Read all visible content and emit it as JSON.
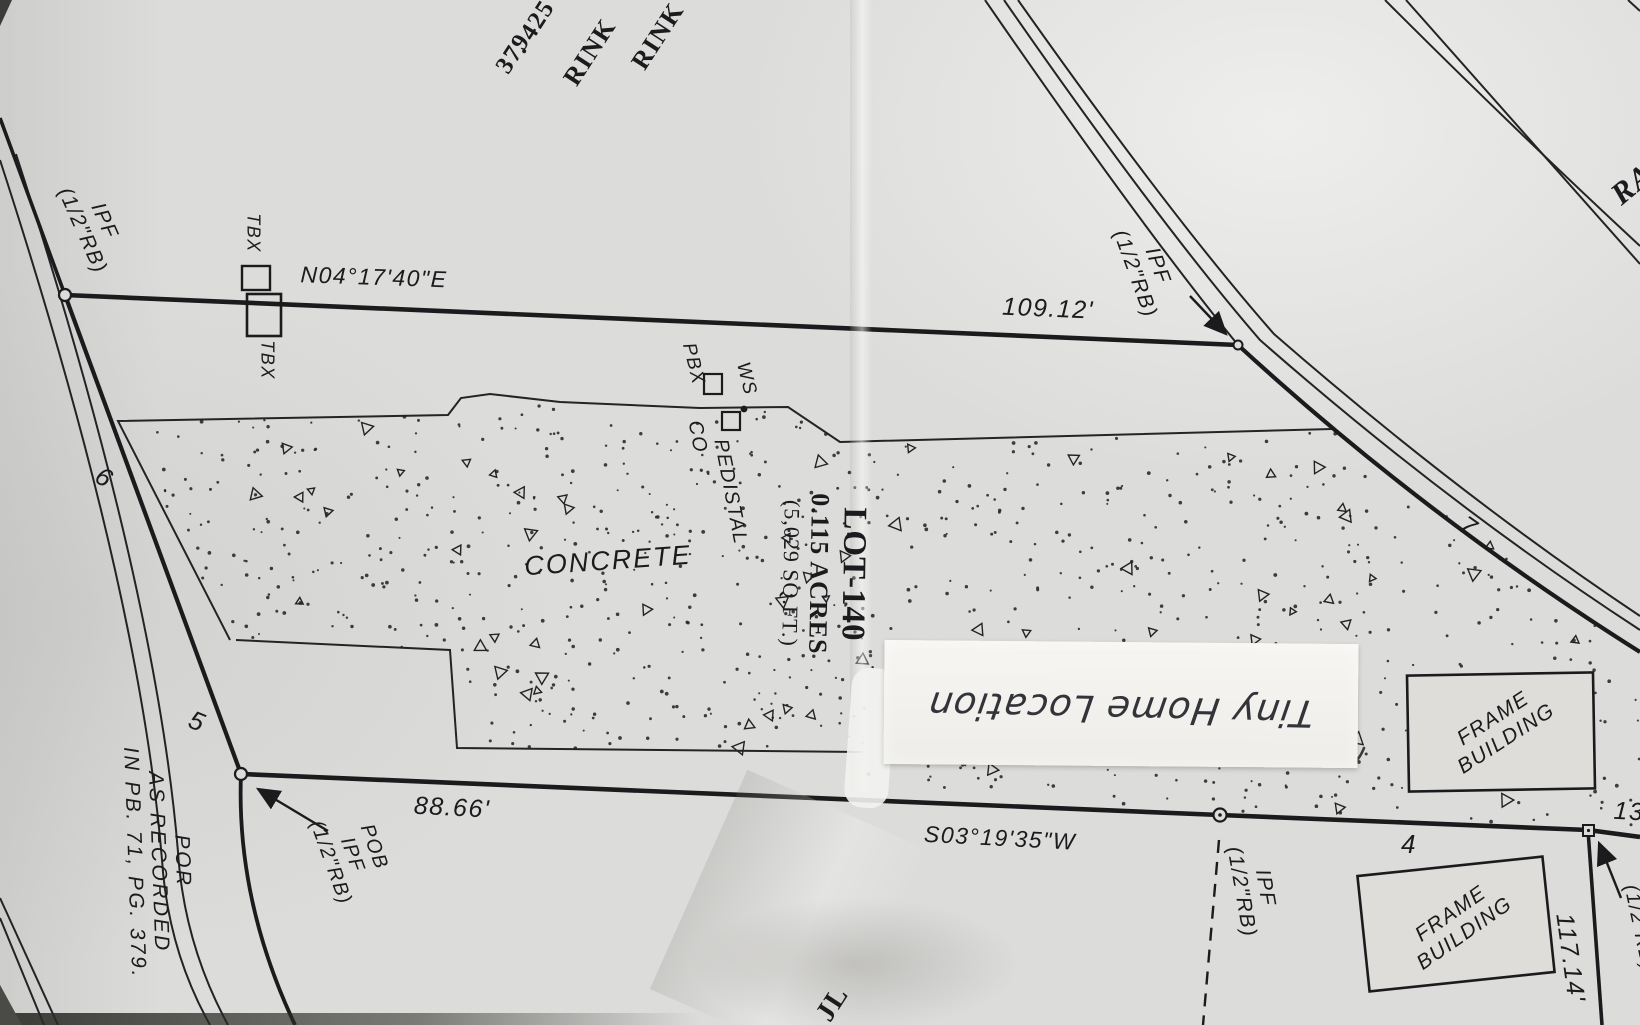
{
  "plat": {
    "corner_fragments": {
      "f1": "RINK",
      "f2": "RINK",
      "f3": ". 425",
      "f4": "379"
    },
    "bearings": {
      "top": "N04°17'40\"E",
      "bottom": "S03°19'35\"W"
    },
    "distances": {
      "top": "109.12'",
      "bottom": "88.66'",
      "right": "117.14'",
      "right_partial": "13"
    },
    "monuments": {
      "ipf_top_left": {
        "line1": "IPF",
        "line2": "(1/2\"RB)"
      },
      "ipf_top_right": {
        "line1": "IPF",
        "line2": "(1/2\"RB)"
      },
      "ipf_bottom": {
        "line1": "IPF",
        "line2": "(1/2\"RB)"
      },
      "ipf_bottom_right_partial": "(1/2\"RB)",
      "pob": {
        "line1": "POB",
        "line2": "IPF",
        "line3": "(1/2\"RB)"
      }
    },
    "labels": {
      "tbx_above": "TBX",
      "tbx_below": "TBX",
      "ws": "WS",
      "pbx": "PBX",
      "pedistal": "PEDISTAL",
      "co": "CO",
      "concrete": "CONCRETE",
      "lot": {
        "name": "LOT-140",
        "acres": "0.115 ACRES",
        "sqft": "(5,029 SQ.FT.)"
      },
      "frame_building_1": {
        "line1": "FRAME",
        "line2": "BUILDING"
      },
      "frame_building_2": {
        "line1": "FRAME",
        "line2": "BUILDING"
      },
      "por": {
        "line1": "POR",
        "line2": "AS RECORDED",
        "line3": "IN PB. 71, PG. 379."
      },
      "road_marker_6": "6",
      "road_marker_5": "5",
      "marker_7": "7",
      "marker_4": "4",
      "road_name_partial": "RA",
      "bottom_partial": "JL"
    },
    "note": {
      "text": "Tiny Home Location"
    }
  },
  "colors": {
    "paper": "#dcdcda",
    "ink": "#1b1b1d",
    "pen": "#33333a",
    "note_paper": "#f4f3f0"
  }
}
